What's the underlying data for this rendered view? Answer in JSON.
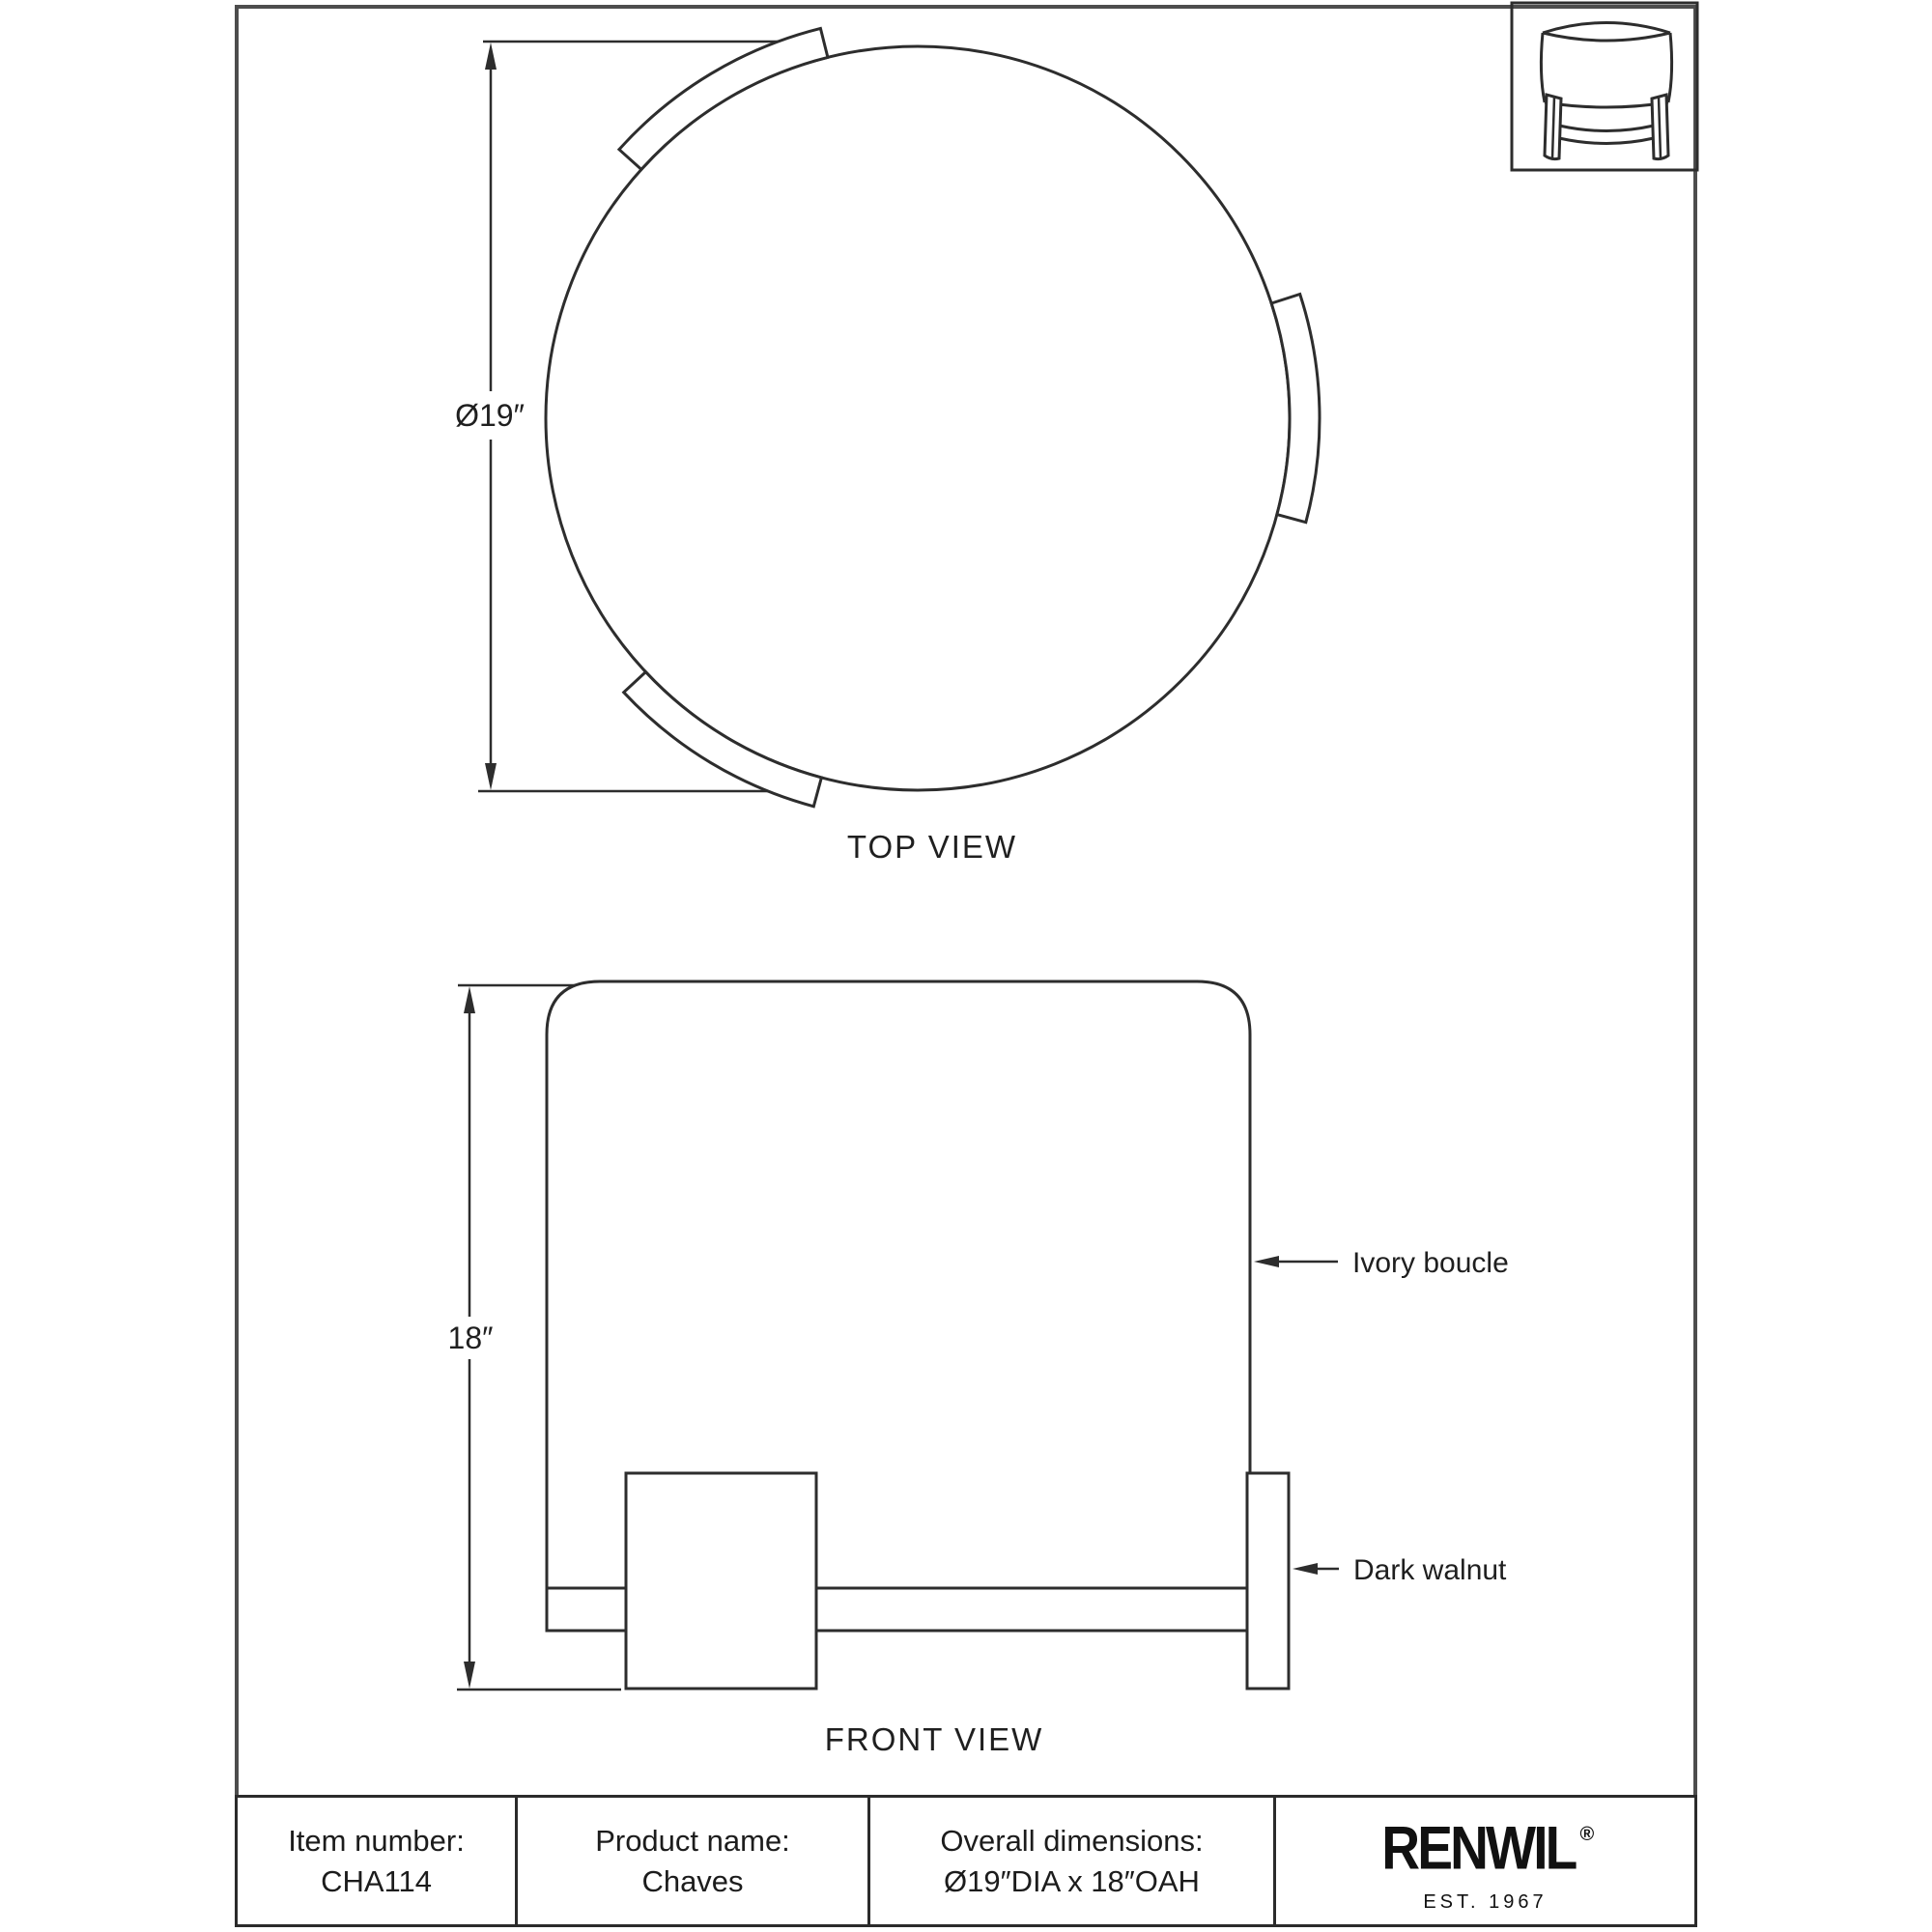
{
  "page": {
    "background": "#ffffff",
    "colors": {
      "drawing_line": "#2d2d2d",
      "page_border": "#4d4d4d",
      "table_border": "#2b2b2b",
      "text": "#1f1f1f",
      "logo": "#111111"
    }
  },
  "top_view": {
    "caption": "TOP VIEW",
    "diameter_label": "Ø19″"
  },
  "front_view": {
    "caption": "FRONT VIEW",
    "height_label": "18″",
    "callout_upholstery": "Ivory boucle",
    "callout_wood": "Dark walnut"
  },
  "thumbnail": {
    "icon_name": "ottoman-pictogram"
  },
  "footer_table": {
    "columns": [
      {
        "label": "Item number:",
        "value": "CHA114"
      },
      {
        "label": "Product name:",
        "value": "Chaves"
      },
      {
        "label": "Overall dimensions:",
        "value": "Ø19″DIA x 18″OAH"
      }
    ],
    "brand": {
      "logo": "RENWIL",
      "registered": "®",
      "tagline": "EST. 1967"
    }
  }
}
